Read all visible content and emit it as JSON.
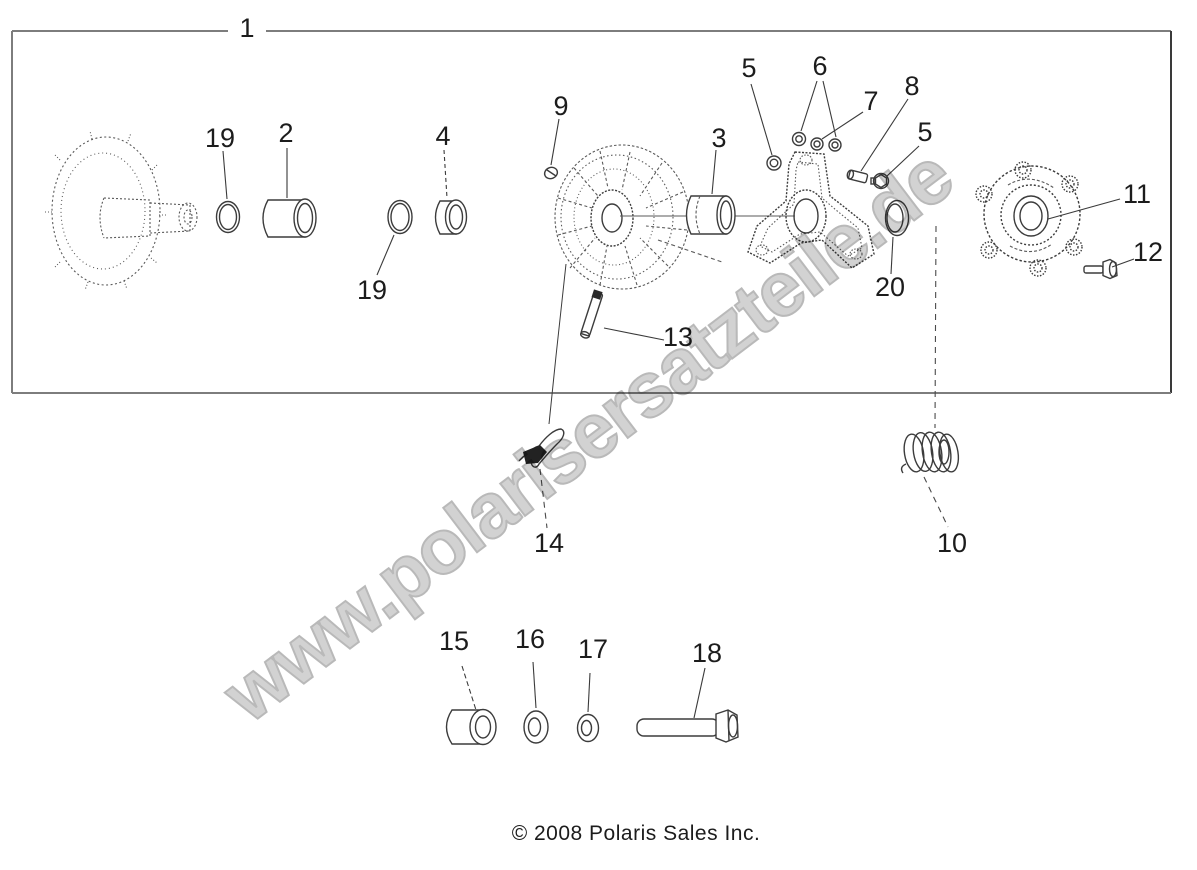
{
  "page": {
    "background": "#ffffff",
    "watermark_text": "www.polarisersatzteile.de",
    "copyright_text": "© 2008 Polaris Sales Inc.",
    "line_color": "#3c3c3c",
    "watermark_color": "#d2d2d2"
  },
  "diagram": {
    "type": "exploded-parts-diagram",
    "assembly_box_label": "1",
    "callouts": [
      {
        "num": "19"
      },
      {
        "num": "2"
      },
      {
        "num": "4"
      },
      {
        "num": "19"
      },
      {
        "num": "9"
      },
      {
        "num": "3"
      },
      {
        "num": "5"
      },
      {
        "num": "6"
      },
      {
        "num": "7"
      },
      {
        "num": "8"
      },
      {
        "num": "5"
      },
      {
        "num": "11"
      },
      {
        "num": "12"
      },
      {
        "num": "20"
      },
      {
        "num": "13"
      },
      {
        "num": "14"
      },
      {
        "num": "10"
      },
      {
        "num": "15"
      },
      {
        "num": "16"
      },
      {
        "num": "17"
      },
      {
        "num": "18"
      }
    ]
  }
}
